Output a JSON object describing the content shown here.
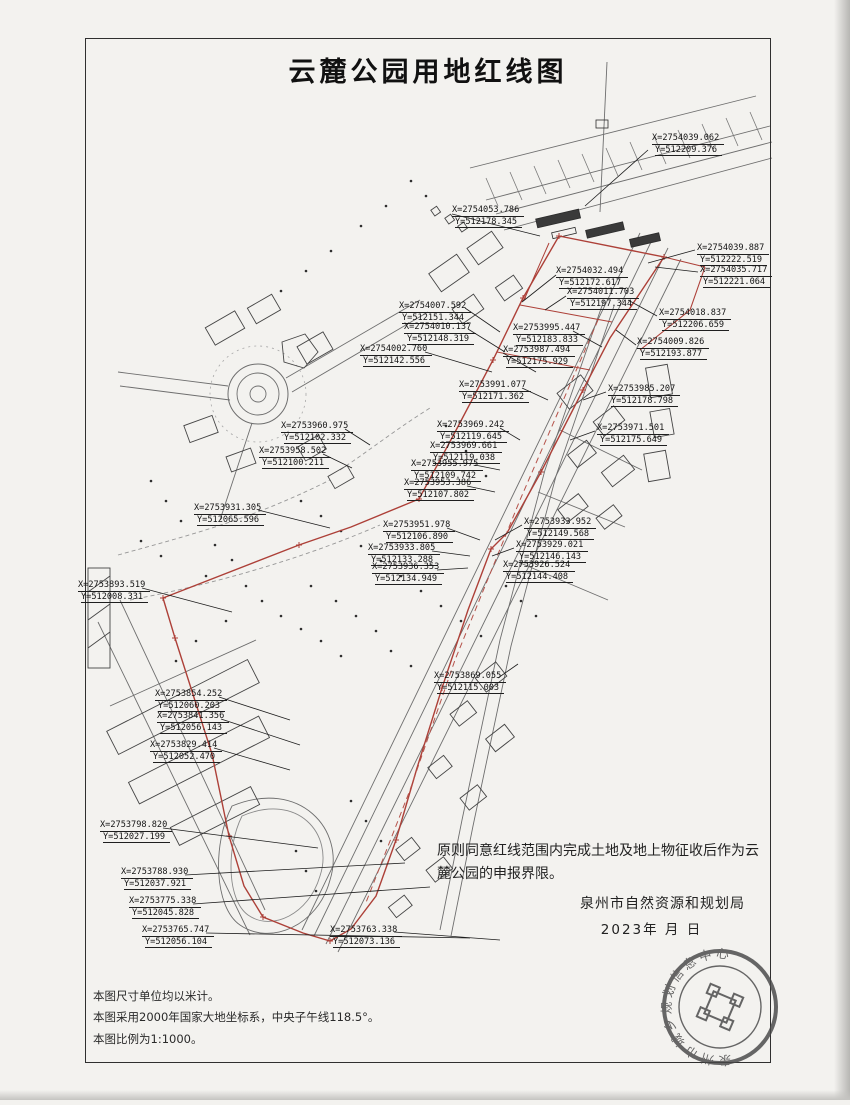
{
  "page": {
    "title": "云麓公园用地红线图"
  },
  "statement": {
    "text": "原则同意红线范围内完成土地及地上物征收后作为云麓公园的申报界限。"
  },
  "signature": {
    "agency": "泉州市自然资源和规划局",
    "date": "2023年 月 日"
  },
  "notes": [
    "本图尺寸单位均以米计。",
    "本图采用2000年国家大地坐标系，中央子午线118.5°。",
    "本图比例为1:1000。"
  ],
  "seal": {
    "ring_text": "泉州市城乡规划信息中心"
  },
  "colors": {
    "red_line": "#ad4038",
    "ink": "#2e2e2e",
    "paper": "#f3f2ef"
  },
  "coordinate_labels": [
    {
      "x": "X=2754039.062",
      "y": "Y=512209.376",
      "left": 652,
      "top": 133
    },
    {
      "x": "X=2754053.786",
      "y": "Y=512178.345",
      "left": 452,
      "top": 205
    },
    {
      "x": "X=2754039.887",
      "y": "Y=512222.519",
      "left": 697,
      "top": 243
    },
    {
      "x": "X=2754035.717",
      "y": "Y=512221.064",
      "left": 700,
      "top": 265
    },
    {
      "x": "X=2754032.494",
      "y": "Y=512172.617",
      "left": 556,
      "top": 266
    },
    {
      "x": "X=2754011.703",
      "y": "Y=512197.344",
      "left": 567,
      "top": 287
    },
    {
      "x": "X=2754018.837",
      "y": "Y=512206.659",
      "left": 659,
      "top": 308
    },
    {
      "x": "X=2754009.826",
      "y": "Y=512193.877",
      "left": 637,
      "top": 337
    },
    {
      "x": "X=2754007.592",
      "y": "Y=512151.344",
      "left": 399,
      "top": 301
    },
    {
      "x": "X=2754010.137",
      "y": "Y=512148.319",
      "left": 404,
      "top": 322
    },
    {
      "x": "X=2754002.760",
      "y": "Y=512142.556",
      "left": 360,
      "top": 344
    },
    {
      "x": "X=2753995.447",
      "y": "Y=512183.833",
      "left": 513,
      "top": 323
    },
    {
      "x": "X=2753987.494",
      "y": "Y=512175.929",
      "left": 503,
      "top": 345
    },
    {
      "x": "X=2753991.077",
      "y": "Y=512171.362",
      "left": 459,
      "top": 380
    },
    {
      "x": "X=2753985.207",
      "y": "Y=512178.798",
      "left": 608,
      "top": 384
    },
    {
      "x": "X=2753971.501",
      "y": "Y=512175.649",
      "left": 597,
      "top": 423
    },
    {
      "x": "X=2753969.242",
      "y": "Y=512119.645",
      "left": 437,
      "top": 420
    },
    {
      "x": "X=2753969.661",
      "y": "Y=512119.038",
      "left": 430,
      "top": 441
    },
    {
      "x": "X=2753955.975",
      "y": "Y=512109.742",
      "left": 411,
      "top": 459
    },
    {
      "x": "X=2753953.386",
      "y": "Y=512107.802",
      "left": 404,
      "top": 478
    },
    {
      "x": "X=2753960.975",
      "y": "Y=512102.332",
      "left": 281,
      "top": 421
    },
    {
      "x": "X=2753958.502",
      "y": "Y=512100.211",
      "left": 259,
      "top": 446
    },
    {
      "x": "X=2753931.305",
      "y": "Y=512065.596",
      "left": 194,
      "top": 503
    },
    {
      "x": "X=2753951.978",
      "y": "Y=512106.890",
      "left": 383,
      "top": 520
    },
    {
      "x": "X=2753933.805",
      "y": "Y=512133.288",
      "left": 368,
      "top": 543
    },
    {
      "x": "X=2753936.353",
      "y": "Y=512134.949",
      "left": 372,
      "top": 562
    },
    {
      "x": "X=2753933.952",
      "y": "Y=512149.568",
      "left": 524,
      "top": 517
    },
    {
      "x": "X=2753929.021",
      "y": "Y=512146.143",
      "left": 516,
      "top": 540
    },
    {
      "x": "X=2753926.524",
      "y": "Y=512144.408",
      "left": 503,
      "top": 560
    },
    {
      "x": "X=2753893.519",
      "y": "Y=512008.331",
      "left": 78,
      "top": 580
    },
    {
      "x": "X=2753869.055",
      "y": "Y=512115.003",
      "left": 434,
      "top": 671
    },
    {
      "x": "X=2753854.252",
      "y": "Y=512060.203",
      "left": 155,
      "top": 689
    },
    {
      "x": "X=2753841.356",
      "y": "Y=512056.143",
      "left": 157,
      "top": 711
    },
    {
      "x": "X=2753829.414",
      "y": "Y=512052.470",
      "left": 150,
      "top": 740
    },
    {
      "x": "X=2753798.820",
      "y": "Y=512027.199",
      "left": 100,
      "top": 820
    },
    {
      "x": "X=2753788.930",
      "y": "Y=512037.921",
      "left": 121,
      "top": 867
    },
    {
      "x": "X=2753775.338",
      "y": "Y=512045.828",
      "left": 129,
      "top": 896
    },
    {
      "x": "X=2753765.747",
      "y": "Y=512056.104",
      "left": 142,
      "top": 925
    },
    {
      "x": "X=2753763.338",
      "y": "Y=512073.136",
      "left": 330,
      "top": 925
    }
  ]
}
